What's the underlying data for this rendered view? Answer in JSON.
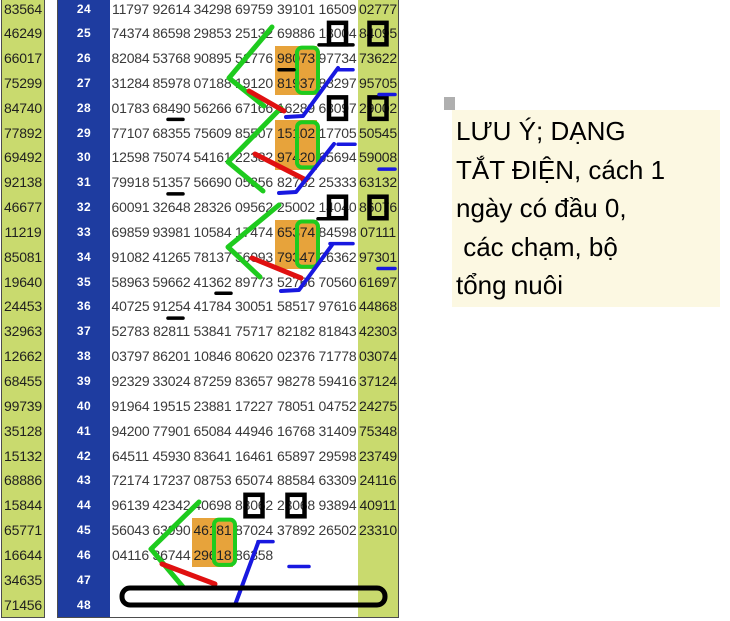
{
  "title": "lottery number grid with hand annotations",
  "colors": {
    "green_cell": "#c9da6e",
    "header_blue": "#1e3ca0",
    "orange_highlight": "#e7a33b",
    "annotation_green": "#1ecb1e",
    "annotation_red": "#e01010",
    "annotation_blue": "#1818e0",
    "annotation_black": "#000000",
    "note_bg": "#fcf8e2"
  },
  "note": {
    "lines": [
      "LƯU Ý; DẠNG",
      "TẮT ĐIỆN, cách 1",
      "ngày có đầu 0,",
      " các chạm, bộ",
      "tổng nuôi"
    ]
  },
  "rows": [
    {
      "n": "24",
      "a": "83564",
      "c": [
        "11797",
        "92614",
        "34298",
        "69759",
        "39101",
        "16509"
      ],
      "b": "02777"
    },
    {
      "n": "25",
      "a": "46249",
      "c": [
        "74374",
        "86598",
        "29853",
        "25132",
        "69886",
        "13004"
      ],
      "b": "84095"
    },
    {
      "n": "26",
      "a": "66017",
      "c": [
        "82084",
        "53768",
        "90895",
        "51776",
        "98073",
        "97734"
      ],
      "b": "73622"
    },
    {
      "n": "27",
      "a": "75299",
      "c": [
        "31284",
        "85978",
        "07188",
        "19120",
        "81937",
        "88297"
      ],
      "b": "95705"
    },
    {
      "n": "28",
      "a": "84740",
      "c": [
        "01783",
        "68490",
        "56266",
        "67166",
        "16289",
        "63097"
      ],
      "b": "29002"
    },
    {
      "n": "29",
      "a": "77892",
      "c": [
        "77107",
        "68355",
        "75609",
        "85507",
        "15102",
        "17705"
      ],
      "b": "50545"
    },
    {
      "n": "30",
      "a": "69492",
      "c": [
        "12598",
        "75074",
        "54161",
        "22382",
        "97420",
        "65694"
      ],
      "b": "59008"
    },
    {
      "n": "31",
      "a": "92138",
      "c": [
        "79918",
        "51357",
        "56690",
        "05356",
        "82782",
        "25333"
      ],
      "b": "63132"
    },
    {
      "n": "32",
      "a": "46677",
      "c": [
        "60091",
        "32648",
        "28326",
        "09562",
        "25002",
        "14040"
      ],
      "b": "86076"
    },
    {
      "n": "33",
      "a": "11219",
      "c": [
        "69859",
        "93981",
        "10584",
        "17474",
        "65374",
        "84598"
      ],
      "b": "07111"
    },
    {
      "n": "34",
      "a": "85081",
      "c": [
        "91082",
        "41265",
        "78137",
        "56093",
        "79347",
        "26362"
      ],
      "b": "97301"
    },
    {
      "n": "35",
      "a": "19640",
      "c": [
        "58963",
        "59662",
        "41362",
        "89773",
        "52766",
        "70560"
      ],
      "b": "61697"
    },
    {
      "n": "36",
      "a": "24453",
      "c": [
        "40725",
        "91254",
        "41784",
        "30051",
        "58517",
        "97616"
      ],
      "b": "44868"
    },
    {
      "n": "37",
      "a": "32963",
      "c": [
        "52783",
        "82811",
        "53841",
        "75717",
        "82182",
        "81843"
      ],
      "b": "42303"
    },
    {
      "n": "38",
      "a": "12662",
      "c": [
        "03797",
        "86201",
        "10846",
        "80620",
        "02376",
        "71778"
      ],
      "b": "03074"
    },
    {
      "n": "39",
      "a": "68455",
      "c": [
        "92329",
        "33024",
        "87259",
        "83657",
        "98278",
        "59416"
      ],
      "b": "37124"
    },
    {
      "n": "40",
      "a": "99739",
      "c": [
        "91964",
        "19515",
        "23881",
        "17227",
        "78051",
        "04752"
      ],
      "b": "24275"
    },
    {
      "n": "41",
      "a": "35128",
      "c": [
        "94200",
        "77901",
        "65084",
        "44946",
        "16768",
        "31409"
      ],
      "b": "75348"
    },
    {
      "n": "42",
      "a": "15132",
      "c": [
        "64511",
        "45930",
        "83641",
        "16461",
        "65897",
        "29598"
      ],
      "b": "23749"
    },
    {
      "n": "43",
      "a": "68886",
      "c": [
        "72174",
        "17237",
        "08753",
        "65074",
        "88584",
        "63309"
      ],
      "b": "24116"
    },
    {
      "n": "44",
      "a": "15844",
      "c": [
        "96139",
        "42342",
        "40698",
        "88062",
        "23068",
        "93894"
      ],
      "b": "40911"
    },
    {
      "n": "45",
      "a": "65771",
      "c": [
        "56043",
        "63990",
        "46181",
        "87024",
        "37892",
        "26502"
      ],
      "b": "23310"
    },
    {
      "n": "46",
      "a": "16644",
      "c": [
        "04116",
        "36744",
        "29618",
        "86358",
        "",
        ""
      ],
      "b": ""
    },
    {
      "n": "47",
      "a": "34635",
      "c": [
        "",
        "",
        "",
        "",
        "",
        ""
      ],
      "b": ""
    },
    {
      "n": "48",
      "a": "71456",
      "c": [
        "",
        "",
        "",
        "",
        "",
        ""
      ],
      "b": ""
    }
  ],
  "highlights": {
    "orange_cells": [
      "26:5",
      "27:5",
      "29:5",
      "30:5",
      "33:5",
      "34:5",
      "45:3",
      "46:3"
    ],
    "green_pair_boxes": [
      "26:5",
      "29:5",
      "33:5",
      "45:3"
    ],
    "black_digit_boxes": [
      "25:6",
      "25:R",
      "28:6",
      "28:R",
      "32:6",
      "32:R",
      "44:4",
      "44:5"
    ],
    "black_underlines": [
      {
        "cell": "25:6",
        "x1": 2,
        "x2": 36
      },
      {
        "cell": "26:5",
        "x1": 4,
        "x2": 19
      },
      {
        "cell": "28:2",
        "x1": 17,
        "x2": 32
      },
      {
        "cell": "31:2",
        "x1": 17,
        "x2": 32
      },
      {
        "cell": "32:6",
        "x1": 1,
        "x2": 19
      },
      {
        "cell": "35:3",
        "x1": 24,
        "x2": 39
      },
      {
        "cell": "36:2",
        "x1": 17,
        "x2": 32
      }
    ],
    "blue_underlines": [
      {
        "cell": "26:6",
        "x1": 20,
        "x2": 36
      },
      {
        "cell": "27:R",
        "x1": 21,
        "x2": 37
      },
      {
        "cell": "29:6",
        "x1": 21,
        "x2": 38
      },
      {
        "cell": "30:R",
        "x1": 21,
        "x2": 37
      },
      {
        "cell": "33:6",
        "x1": 13,
        "x2": 36
      },
      {
        "cell": "34:R",
        "x1": 20,
        "x2": 37
      },
      {
        "cell": "45:4",
        "x1": 25,
        "x2": 40
      },
      {
        "cell": "46:5",
        "x1": 14,
        "x2": 34
      }
    ]
  }
}
